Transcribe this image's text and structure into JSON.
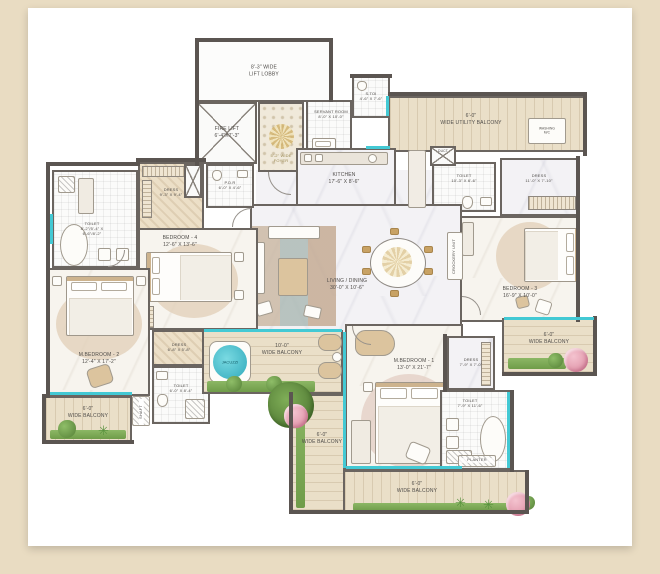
{
  "labels": {
    "lift_lobby": "8'-3\" WIDE\nLIFT LOBBY",
    "fire_lift": "FIRE LIFT\n6'-4\"X7'-3\"",
    "foyer": "5'-2\" WIDE\nFOYER",
    "servant_room": "SERVANT ROOM\n8'-0\" X 10'-0\"",
    "s_toi": "S.TOI\n4'-6\" X 7'-6\"",
    "utility_balcony": "6'-0\"\nWIDE UTILITY BALCONY",
    "washing": "WASHING\nM/C",
    "kitchen": "KITCHEN\n17'-6\" X 8'-6\"",
    "duct": "DUCT",
    "toilet_b3": "TOILET\n10'-3\" X 6'-6\"",
    "dress_b3": "DRESS\n11'-0\" X 7'-10\"",
    "bedroom3": "BEDROOM - 3\n16'-9\" X 10'-0\"",
    "balcony_right": "6'-0\"\nWIDE BALCONY",
    "living": "LIVING / DINING\n30'-0\" X 10'-6\"",
    "crockery": "CROCKERY UNIT",
    "dress_left": "DRESS\n9'-3\" X 9'-4\"",
    "pdr": "P.D.R\n6'-0\" X 4'-6\"",
    "toilet_left": "TOILET\n8'-2\"/5'-4\" X\n6'-6\"/8'-2\"",
    "bedroom4": "BEDROOM - 4\n12'-6\" X 13'-6\"",
    "mbedroom2": "M.BEDROOM - 2\n12'-4\" X 17'-2\"",
    "dress_mb2": "DRESS\n6'-8\" X 5'-8\"",
    "toilet_mb2": "TOILET\n6'-0\" X 8'-4\"",
    "shaft": "SHAFT",
    "balcony_left": "6'-0\"\nWIDE BALCONY",
    "middle_balcony": "10'-0\"\nWIDE BALCONY",
    "jacuzzi": "JACUZZI",
    "mbedroom1": "M.BEDROOM - 1\n13'-0\" X 21'-7\"",
    "dress_mb1": "DRESS\n7'-9\" X 7'-0\"",
    "toilet_mb1": "TOILET\n7'-9\" X 11'-6\"",
    "planter": "PLANTER",
    "balcony_arm": "6'-0\"\nWIDE BALCONY",
    "balcony_bottom": "6'-0\"\nWIDE BALCONY"
  },
  "colors": {
    "page_bg": "#e9dcc2",
    "wall": "#5b5551",
    "glass_window": "#43c9d4",
    "balcony_wood": "#eadfc8",
    "planter_green": "#6f9c49",
    "jacuzzi_water": "#2fa9bb",
    "flower_pink": "#d9879d",
    "gold_accent": "#c8a264"
  }
}
